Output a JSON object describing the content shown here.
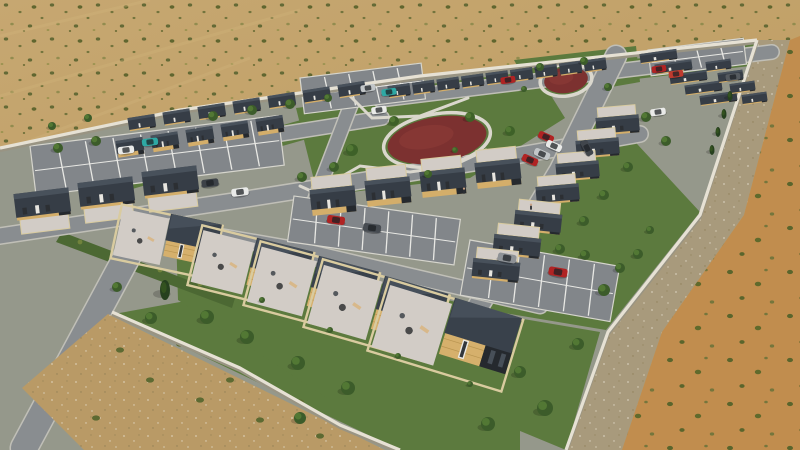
{
  "meta": {
    "title": "Desert housing development – aerial 3D render",
    "description": "Aerial 3D architectural rendering of a walled desert housing development: diagonal rows of small flat-roofed modular homes with dark charcoal roofs and tan timber walls, grey streets and striped parking lots with parked cars, green lawns and trees, a central park with dark-red oval play surfaces, gravel patios with furniture in the foreground yards, all surrounded by sandy desert scrub."
  },
  "palette": {
    "sand": "#c6a771",
    "sand2": "#bd9b60",
    "orange": "#c18d4e",
    "gravel_band": "#a89a7c",
    "shrub": "#5a6430",
    "shrub_light": "#8d8a4b",
    "base": "#95988b",
    "lawn": "#5c7a3e",
    "lawn_dark": "#4c6833",
    "road": "#898d90",
    "road_edge": "#c0bfb7",
    "parking": "#82868a",
    "stripe": "#e8e8e4",
    "roof": "#363d46",
    "roof_hi": "#4d5660",
    "roof_dk": "#2d333a",
    "wood": "#d4ae6a",
    "wood_line": "#b99551",
    "dark_wall": "#25292e",
    "fence": "#d9cb9f",
    "patio": "#d2ccc6",
    "wall": "#e6e1d4",
    "wall_shadow": "#999483",
    "park_red": "#7c3130",
    "path": "#dad7cd",
    "dirt": "#b2placeholder"
  },
  "scene": {
    "dev_base": [
      [
        0,
        148
      ],
      [
        180,
        110
      ],
      [
        420,
        76
      ],
      [
        757,
        40
      ],
      [
        700,
        215
      ],
      [
        608,
        332
      ],
      [
        566,
        450
      ],
      [
        0,
        450
      ]
    ],
    "gravel_band": [
      [
        757,
        40
      ],
      [
        700,
        215
      ],
      [
        608,
        332
      ],
      [
        566,
        450
      ],
      [
        622,
        450
      ],
      [
        662,
        332
      ],
      [
        744,
        215
      ],
      [
        790,
        40
      ]
    ],
    "orange_zone": [
      [
        790,
        40
      ],
      [
        744,
        215
      ],
      [
        662,
        332
      ],
      [
        622,
        450
      ],
      [
        800,
        450
      ],
      [
        800,
        36
      ]
    ],
    "streaks": [
      [
        [
          0,
          36
        ],
        [
          150,
          0
        ]
      ],
      [
        [
          0,
          96
        ],
        [
          300,
          10
        ]
      ],
      [
        [
          0,
          152
        ],
        [
          250,
          58
        ]
      ]
    ],
    "walls": [
      [
        [
          0,
          148
        ],
        [
          180,
          110
        ],
        [
          420,
          76
        ],
        [
          757,
          40
        ]
      ],
      [
        [
          757,
          40
        ],
        [
          700,
          215
        ],
        [
          608,
          332
        ],
        [
          566,
          450
        ]
      ],
      [
        [
          112,
          312
        ],
        [
          240,
          368
        ],
        [
          340,
          425
        ],
        [
          400,
          450
        ]
      ]
    ],
    "lawns": [
      [
        [
          96,
          178
        ],
        [
          428,
          84
        ],
        [
          436,
          102
        ],
        [
          108,
          196
        ]
      ],
      [
        [
          430,
          84
        ],
        [
          756,
          44
        ],
        [
          750,
          66
        ],
        [
          436,
          102
        ]
      ],
      [
        [
          296,
          108
        ],
        [
          540,
          78
        ],
        [
          565,
          118
        ],
        [
          470,
          178
        ],
        [
          318,
          196
        ]
      ],
      [
        [
          514,
          60
        ],
        [
          636,
          46
        ],
        [
          640,
          82
        ],
        [
          536,
          100
        ]
      ],
      [
        [
          600,
          104
        ],
        [
          700,
          212
        ],
        [
          606,
          330
        ],
        [
          474,
          308
        ],
        [
          556,
          176
        ]
      ],
      [
        [
          114,
          314
        ],
        [
          268,
          286
        ],
        [
          520,
          410
        ],
        [
          520,
          450
        ],
        [
          400,
          450
        ]
      ],
      [
        [
          176,
          232
        ],
        [
          520,
          318
        ],
        [
          560,
          420
        ],
        [
          430,
          450
        ],
        [
          330,
          400
        ],
        [
          178,
          300
        ]
      ],
      [
        [
          470,
          310
        ],
        [
          600,
          332
        ],
        [
          566,
          450
        ],
        [
          508,
          426
        ]
      ]
    ],
    "median": [
      [
        62,
        232
      ],
      [
        235,
        298
      ],
      [
        232,
        308
      ],
      [
        56,
        242
      ]
    ],
    "median_tufts": [
      [
        80,
        242
      ],
      [
        120,
        256
      ],
      [
        160,
        270
      ],
      [
        200,
        284
      ]
    ],
    "roads": [
      {
        "pts": [
          [
            380,
            100
          ],
          [
            772,
            52
          ]
        ],
        "w": 13
      },
      {
        "pts": [
          [
            104,
            162
          ],
          [
            382,
            118
          ]
        ],
        "w": 13
      },
      {
        "pts": [
          [
            0,
            236
          ],
          [
            240,
            200
          ],
          [
            480,
            162
          ],
          [
            640,
            134
          ]
        ],
        "w": 15
      },
      {
        "pts": [
          [
            616,
            56
          ],
          [
            560,
            170
          ],
          [
            470,
            320
          ]
        ],
        "w": 20
      },
      {
        "pts": [
          [
            352,
            102
          ],
          [
            316,
            196
          ],
          [
            290,
            272
          ]
        ],
        "w": 13
      },
      {
        "pts": [
          [
            138,
            236
          ],
          [
            24,
            448
          ]
        ],
        "w": 26
      },
      {
        "pts": [
          [
            196,
            232
          ],
          [
            300,
            250
          ],
          [
            480,
            292
          ],
          [
            540,
            306
          ]
        ],
        "w": 14
      }
    ],
    "dirt_wedge": [
      [
        108,
        314
      ],
      [
        385,
        450
      ],
      [
        84,
        450
      ],
      [
        22,
        388
      ]
    ],
    "dirt_shrubs": [
      [
        150,
        380
      ],
      [
        200,
        400
      ],
      [
        260,
        420
      ],
      [
        320,
        436
      ],
      [
        120,
        350
      ],
      [
        96,
        418
      ],
      [
        230,
        380
      ],
      [
        300,
        402
      ],
      [
        180,
        344
      ]
    ],
    "parking_lots": [
      {
        "x": 30,
        "y": 146,
        "w": 250,
        "h": 50,
        "a": -7,
        "n": 9
      },
      {
        "x": 300,
        "y": 78,
        "w": 122,
        "h": 36,
        "a": -7,
        "n": 5
      },
      {
        "x": 294,
        "y": 196,
        "w": 168,
        "h": 46,
        "a": 8,
        "n": 7
      },
      {
        "x": 470,
        "y": 240,
        "w": 152,
        "h": 56,
        "a": 10,
        "n": 6
      },
      {
        "x": 648,
        "y": 50,
        "w": 96,
        "h": 26,
        "a": -7,
        "n": 4
      }
    ],
    "parks": [
      {
        "cx": 437,
        "cy": 140,
        "rx": 50,
        "ry": 23,
        "rot": -10
      },
      {
        "cx": 566,
        "cy": 80,
        "rx": 22,
        "ry": 13,
        "rot": -8
      }
    ],
    "paths": [
      [
        [
          318,
          190
        ],
        [
          360,
          166
        ],
        [
          410,
          172
        ],
        [
          452,
          166
        ],
        [
          486,
          150
        ]
      ],
      [
        [
          350,
          96
        ],
        [
          372,
          118
        ],
        [
          420,
          116
        ],
        [
          468,
          98
        ]
      ],
      [
        [
          300,
          186
        ],
        [
          322,
          196
        ]
      ]
    ],
    "house_rows": [
      {
        "x": 128,
        "y": 118,
        "dx": 35,
        "dy": -5.5,
        "n": 7,
        "w": 26,
        "h": 12,
        "a": -9,
        "v": "dark"
      },
      {
        "x": 116,
        "y": 141,
        "dx": 35,
        "dy": -5.5,
        "n": 5,
        "w": 26,
        "h": 13,
        "a": -9,
        "v": "tan"
      },
      {
        "x": 388,
        "y": 86,
        "dx": 24.5,
        "dy": -3.2,
        "n": 9,
        "w": 21,
        "h": 11,
        "a": -8,
        "v": "dark"
      },
      {
        "x": 640,
        "y": 54,
        "dx": 15,
        "dy": 10.5,
        "n": 5,
        "w": 36,
        "h": 9,
        "a": -8,
        "v": "dark"
      },
      {
        "x": 706,
        "y": 62,
        "dx": 12,
        "dy": 11,
        "n": 4,
        "w": 24,
        "h": 9,
        "a": -8,
        "v": "dark"
      },
      {
        "x": 14,
        "y": 194,
        "dx": 64,
        "dy": -11,
        "n": 3,
        "w": 54,
        "h": 24,
        "a": -7,
        "v": "mid",
        "patio": "down"
      },
      {
        "x": 310,
        "y": 190,
        "dx": 55,
        "dy": -9,
        "n": 4,
        "w": 44,
        "h": 20,
        "a": -6,
        "v": "midtan",
        "patio": "up"
      },
      {
        "x": 596,
        "y": 118,
        "dx": -20,
        "dy": 23,
        "n": 4,
        "w": 42,
        "h": 16,
        "a": -5,
        "v": "mid",
        "patio": "up"
      },
      {
        "x": 516,
        "y": 210,
        "dx": -21,
        "dy": 24,
        "n": 3,
        "w": 46,
        "h": 18,
        "a": 6,
        "v": "mid",
        "patio": "up"
      }
    ],
    "big_houses": [
      {
        "x": 172,
        "y": 214,
        "s": 50,
        "a": 12
      },
      {
        "x": 258,
        "y": 238,
        "s": 56,
        "a": 14
      },
      {
        "x": 320,
        "y": 256,
        "s": 60,
        "a": 15
      },
      {
        "x": 386,
        "y": 276,
        "s": 64,
        "a": 16
      },
      {
        "x": 456,
        "y": 298,
        "s": 68,
        "a": 17
      }
    ],
    "trees": [
      [
        213,
        116,
        5,
        "g"
      ],
      [
        252,
        110,
        5,
        "g"
      ],
      [
        290,
        104,
        5,
        "g"
      ],
      [
        328,
        98,
        4,
        "g"
      ],
      [
        58,
        148,
        5,
        "g"
      ],
      [
        96,
        141,
        5,
        "g"
      ],
      [
        52,
        126,
        4,
        "g"
      ],
      [
        88,
        118,
        4,
        "g"
      ],
      [
        352,
        150,
        6,
        "p"
      ],
      [
        394,
        121,
        5,
        "p"
      ],
      [
        470,
        117,
        5,
        "p"
      ],
      [
        510,
        131,
        5,
        "p"
      ],
      [
        334,
        167,
        5,
        "g"
      ],
      [
        428,
        174,
        4,
        "p"
      ],
      [
        302,
        177,
        5,
        "g"
      ],
      [
        455,
        150,
        3,
        "p"
      ],
      [
        540,
        67,
        4,
        "g"
      ],
      [
        584,
        61,
        4,
        "g"
      ],
      [
        608,
        87,
        4,
        "g"
      ],
      [
        524,
        89,
        3,
        "g"
      ],
      [
        646,
        117,
        5,
        "g"
      ],
      [
        666,
        141,
        5,
        "g"
      ],
      [
        628,
        167,
        5,
        "g"
      ],
      [
        604,
        195,
        5,
        "g"
      ],
      [
        584,
        221,
        5,
        "g"
      ],
      [
        560,
        249,
        5,
        "g"
      ],
      [
        604,
        290,
        6,
        "g"
      ],
      [
        638,
        254,
        5,
        "g"
      ],
      [
        650,
        230,
        4,
        "g"
      ],
      [
        730,
        96,
        4,
        "c"
      ],
      [
        724,
        114,
        4,
        "c"
      ],
      [
        718,
        132,
        4,
        "c"
      ],
      [
        712,
        150,
        4,
        "c"
      ],
      [
        165,
        290,
        8,
        "c"
      ],
      [
        151,
        318,
        6,
        "g"
      ],
      [
        207,
        317,
        7,
        "g"
      ],
      [
        247,
        337,
        7,
        "g"
      ],
      [
        298,
        363,
        7,
        "g"
      ],
      [
        117,
        287,
        5,
        "g"
      ],
      [
        348,
        388,
        7,
        "g"
      ],
      [
        300,
        418,
        6,
        "g"
      ],
      [
        545,
        408,
        8,
        "g"
      ],
      [
        578,
        344,
        6,
        "g"
      ],
      [
        520,
        372,
        6,
        "g"
      ],
      [
        488,
        424,
        7,
        "g"
      ],
      [
        585,
        255,
        5,
        "g"
      ],
      [
        620,
        268,
        5,
        "g"
      ],
      [
        262,
        300,
        3,
        "g"
      ],
      [
        330,
        330,
        3,
        "g"
      ],
      [
        398,
        356,
        3,
        "g"
      ],
      [
        470,
        384,
        3,
        "g"
      ]
    ],
    "cars": [
      {
        "x": 508,
        "y": 80,
        "a": -8,
        "c": "#b02323"
      },
      {
        "x": 659,
        "y": 69,
        "a": -8,
        "c": "#b02323"
      },
      {
        "x": 676,
        "y": 74,
        "a": -8,
        "c": "#c03a2e"
      },
      {
        "x": 733,
        "y": 77,
        "a": -8,
        "c": "#555a5f"
      },
      {
        "x": 368,
        "y": 88,
        "a": -8,
        "c": "#c2c6c8"
      },
      {
        "x": 389,
        "y": 92,
        "a": -8,
        "c": "#2ea8a4"
      },
      {
        "x": 379,
        "y": 110,
        "a": -8,
        "c": "#e9eae8"
      },
      {
        "x": 546,
        "y": 137,
        "a": 24,
        "c": "#b02323"
      },
      {
        "x": 554,
        "y": 146,
        "a": 24,
        "c": "#e9eae8"
      },
      {
        "x": 542,
        "y": 154,
        "a": 24,
        "c": "#c2c6c8"
      },
      {
        "x": 530,
        "y": 160,
        "a": 24,
        "c": "#b02323"
      },
      {
        "x": 587,
        "y": 148,
        "a": 62,
        "c": "#41464c"
      },
      {
        "x": 658,
        "y": 112,
        "a": -8,
        "c": "#e9eae8"
      },
      {
        "x": 150,
        "y": 142,
        "a": -7,
        "c": "#2ea8a4"
      },
      {
        "x": 126,
        "y": 150,
        "a": -7,
        "c": "#e9eae8"
      },
      {
        "x": 210,
        "y": 183,
        "a": -7,
        "c": "#3d4248"
      },
      {
        "x": 240,
        "y": 192,
        "a": -7,
        "c": "#e9eae8"
      },
      {
        "x": 336,
        "y": 220,
        "a": 8,
        "c": "#b02323"
      },
      {
        "x": 372,
        "y": 228,
        "a": 8,
        "c": "#474c52"
      },
      {
        "x": 507,
        "y": 258,
        "a": 10,
        "c": "#8e9296"
      },
      {
        "x": 558,
        "y": 272,
        "a": 10,
        "c": "#b02323"
      }
    ],
    "people": [
      [
        531,
        208
      ],
      [
        464,
        192
      ]
    ]
  }
}
